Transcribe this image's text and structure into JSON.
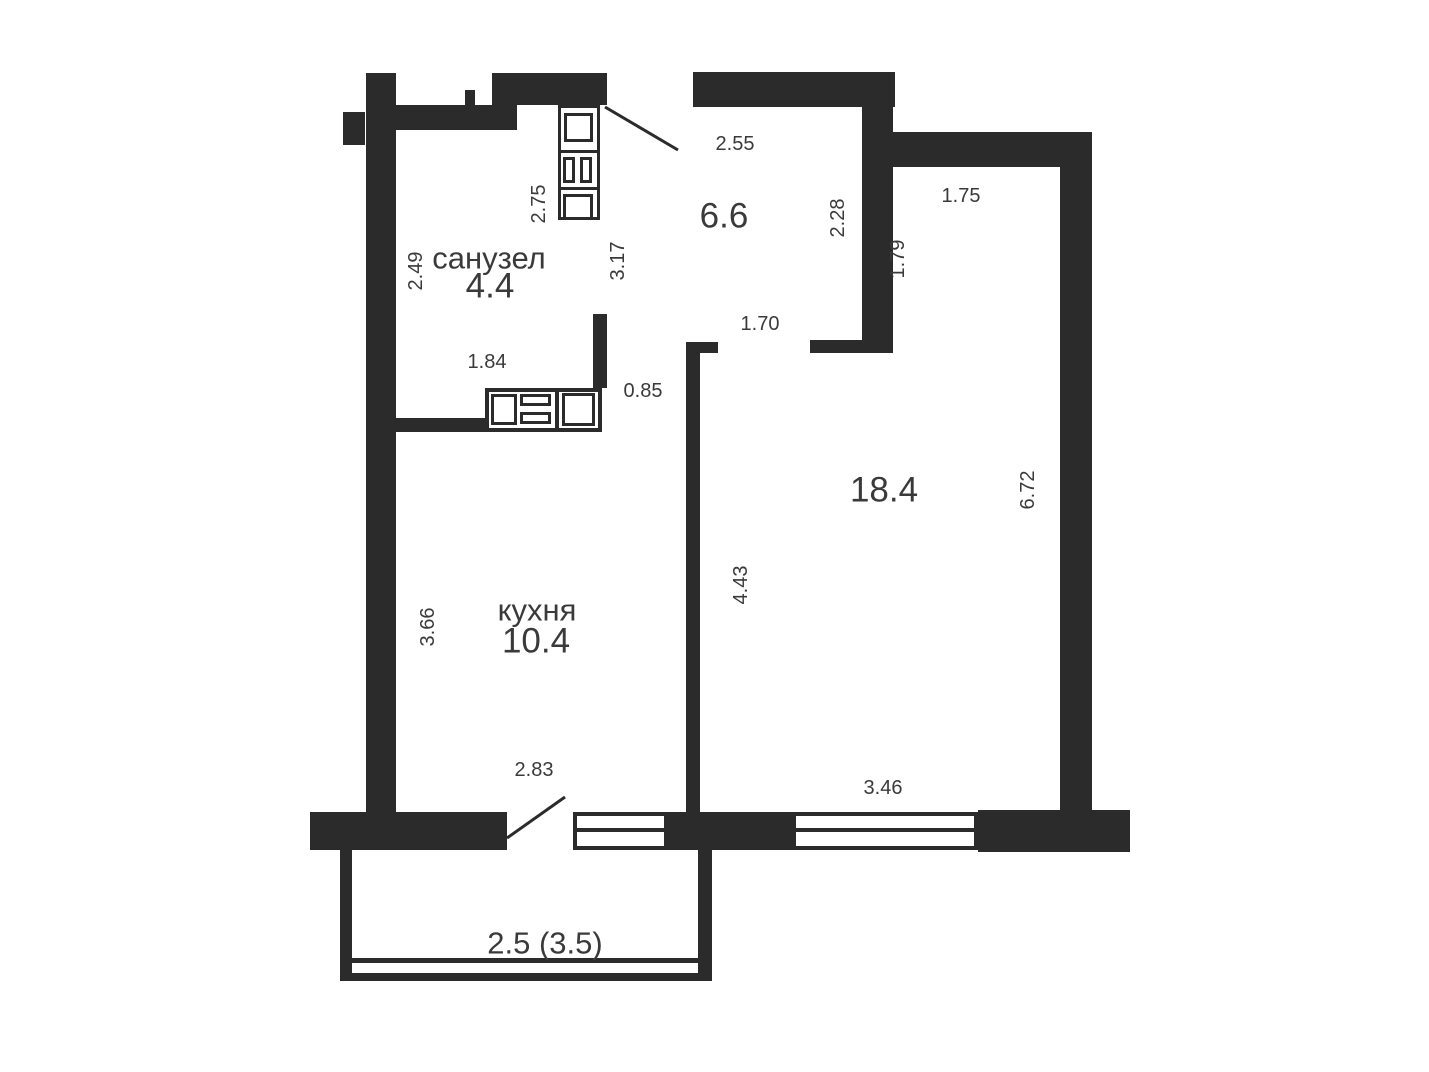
{
  "colors": {
    "wall": "#2b2b2b",
    "text": "#3a3a3a",
    "bg": "#ffffff"
  },
  "rooms": {
    "bathroom": {
      "name": "санузел",
      "area": "4.4"
    },
    "hallway": {
      "area": "6.6"
    },
    "kitchen": {
      "name": "кухня",
      "area": "10.4"
    },
    "living": {
      "area": "18.4"
    },
    "balcony": {
      "area": "2.5 (3.5)"
    }
  },
  "dimensions": {
    "hall_top": "2.55",
    "bath_fixture": "2.75",
    "bath_left": "2.49",
    "bath_hall": "3.17",
    "hall_right": "2.28",
    "living_top": "1.75",
    "living_upper_left": "1.79",
    "living_right": "6.72",
    "living_left": "4.43",
    "kitchen_left": "3.66",
    "bath_bottom": "1.84",
    "bath_door": "0.85",
    "living_door": "1.70",
    "kitchen_bottom": "2.83",
    "living_window": "3.46"
  },
  "icons": {
    "bathroom_column": "washer-sink-unit",
    "kitchen_counter": "counter-sink-stove",
    "entry_door": "door-swing",
    "balcony_door": "door-swing",
    "windows": "double-line-window"
  }
}
